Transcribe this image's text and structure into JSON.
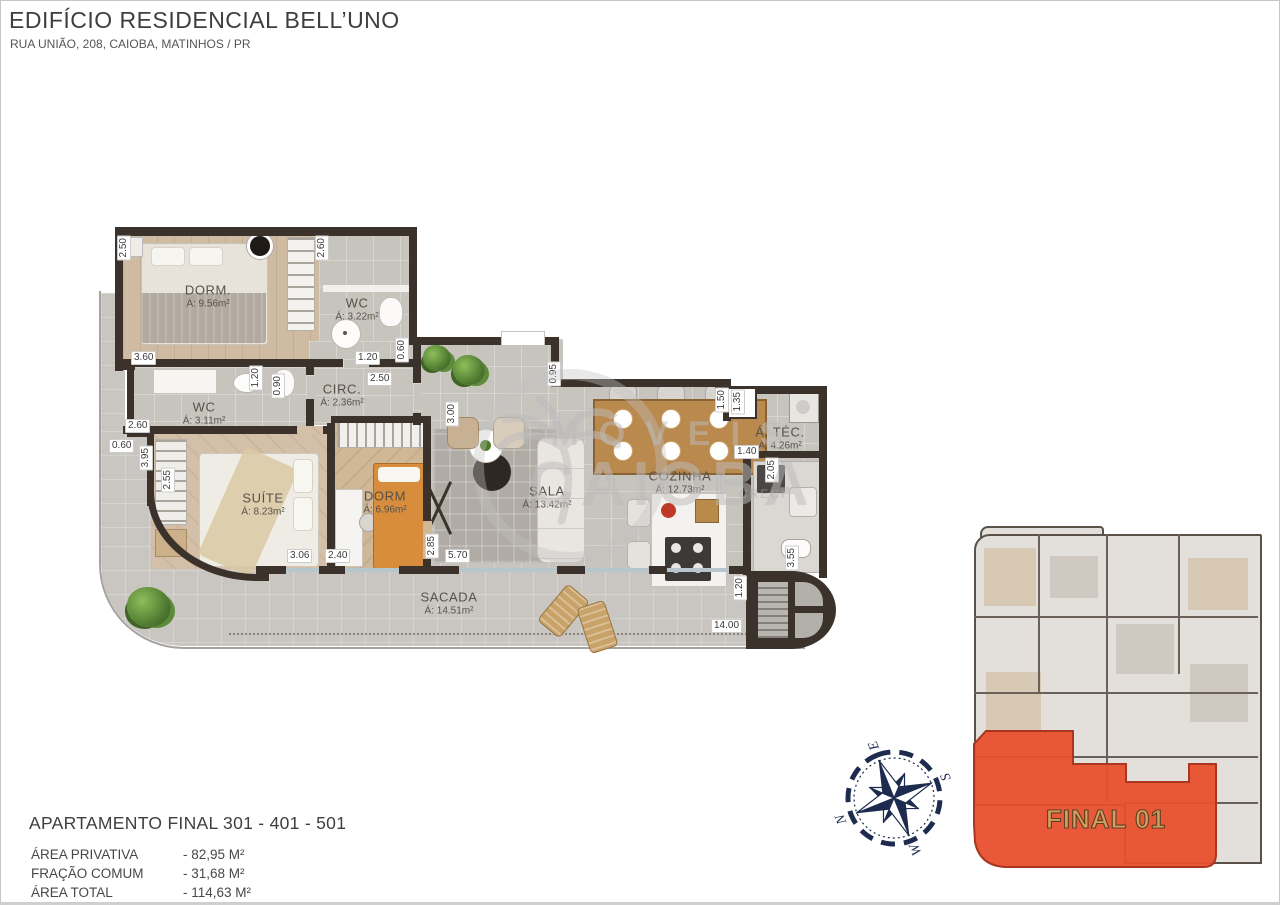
{
  "header": {
    "title": "EDIFÍCIO RESIDENCIAL BELL’UNO",
    "subtitle": "RUA UNIÃO, 208, CAIOBA, MATINHOS / PR"
  },
  "watermark": {
    "line1": "IMÓVEIS",
    "line2": "CAIOBA",
    "creci": "CRECI"
  },
  "plan": {
    "rooms": [
      {
        "name": "DORM.",
        "area": "Á: 9.56m²"
      },
      {
        "name": "WC",
        "area": "Á: 3.22m²"
      },
      {
        "name": "WC",
        "area": "Á: 3.11m²"
      },
      {
        "name": "CIRC.",
        "area": "Á: 2.36m²"
      },
      {
        "name": "SUÍTE",
        "area": "Á: 8.23m²"
      },
      {
        "name": "DORM",
        "area": "Á: 6.96m²"
      },
      {
        "name": "SALA",
        "area": "Á: 13.42m²"
      },
      {
        "name": "COZINHA",
        "area": "Á: 12.73m²"
      },
      {
        "name": "Á. TÉC.",
        "area": "Á: 4.26m²"
      },
      {
        "name": "SACADA",
        "area": "Á: 14.51m²"
      }
    ],
    "dims": [
      "2.50",
      "2.60",
      "3.60",
      "1.20",
      "0.60",
      "2.50",
      "1.20",
      "0.90",
      "0.95",
      "2.60",
      "0.60",
      "3.95",
      "2.55",
      "3.06",
      "2.40",
      "2.85",
      "3.00",
      "5.70",
      "1.50",
      "1.35",
      "1.40",
      "2.05",
      "3.55",
      "1.20",
      "14.00"
    ]
  },
  "footer": {
    "apartment_title": "APARTAMENTO FINAL 301 - 401 - 501",
    "stats": [
      {
        "label": "ÁREA PRIVATIVA",
        "value": "- 82,95 M²"
      },
      {
        "label": "FRAÇÃO COMUM",
        "value": "- 31,68 M²"
      },
      {
        "label": "ÁREA TOTAL",
        "value": "- 114,63 M²"
      }
    ]
  },
  "compass": {
    "n": "N",
    "e": "E",
    "s": "S",
    "w": "W"
  },
  "keyplan": {
    "unit_label": "FINAL 01",
    "highlight_color": "#e84f2d"
  }
}
